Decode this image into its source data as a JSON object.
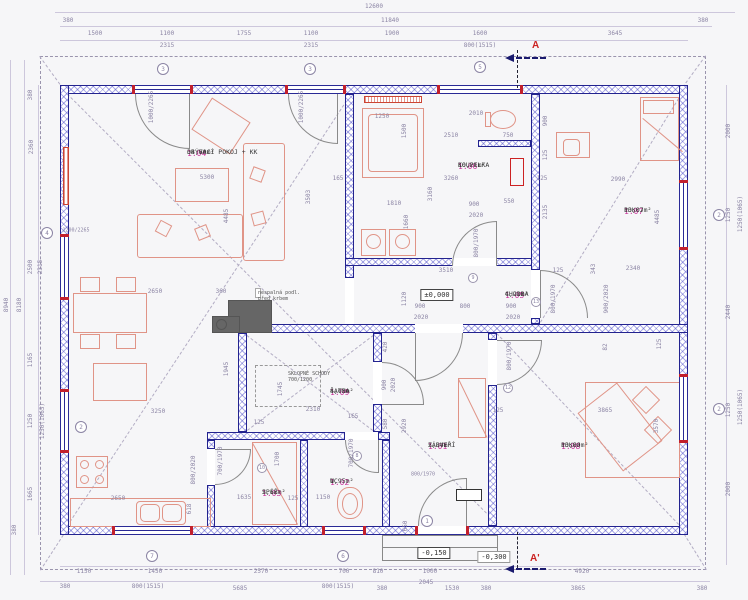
{
  "rooms": [
    {
      "id": "1.01",
      "name": "ZÁDVEŘÍ",
      "area": "5,84m²"
    },
    {
      "id": "1.02",
      "name": "WC",
      "area": "1,95m²"
    },
    {
      "id": "1.03",
      "name": "SPÍŽ",
      "area": "2,66m²"
    },
    {
      "id": "1.04",
      "name": "OBÝVACÍ POKOJ + KK",
      "area": "34,60m²"
    },
    {
      "id": "1.05",
      "name": "CHODBA",
      "area": "4,21m²"
    },
    {
      "id": "1.06",
      "name": "KOUPELKA",
      "area": "10,21m²"
    },
    {
      "id": "1.07",
      "name": "POKOJ",
      "area": "13,07m²"
    },
    {
      "id": "1.08",
      "name": "POKOJ",
      "area": "13,80m²"
    },
    {
      "id": "1.09",
      "name": "ŠATNA",
      "area": "4,03m²"
    }
  ],
  "levels": {
    "zero": "±0,000",
    "minus150": "-0,150",
    "minus300": "-0,300"
  },
  "sections": {
    "top": "A",
    "bottom": "A'"
  },
  "notes": {
    "fireplace_line1": "nespalná podl.",
    "fireplace_line2": "před krbem",
    "stairs_line1": "SKLOPNÉ SCHODY",
    "stairs_line2": "700/1200"
  },
  "bubbles": [
    "3",
    "3",
    "5",
    "4",
    "2",
    "2",
    "2",
    "7",
    "6",
    "1"
  ],
  "tags": [
    "9",
    "13",
    "12",
    "10",
    "8"
  ],
  "dims": {
    "top": [
      "12600",
      "11840",
      "380",
      "380",
      "1500",
      "1100",
      "1755",
      "1100",
      "1900",
      "1600",
      "3645",
      "2315",
      "2315",
      "800(1515)"
    ],
    "left": [
      "8940",
      "8180",
      "380",
      "2360",
      "2500",
      "2315",
      "1165",
      "1250",
      "1250(1065)",
      "1665",
      "380"
    ],
    "right": [
      "2000",
      "1250",
      "1250(1065)",
      "2440",
      "1250",
      "1250(1065)",
      "2000"
    ],
    "bottom": [
      "1150",
      "1450",
      "2570",
      "700",
      "810",
      "1000",
      "4920",
      "380",
      "800(1515)",
      "5685",
      "800(1515)",
      "380",
      "2045",
      "1530",
      "380",
      "3865",
      "380"
    ],
    "inner": [
      "1000/2265",
      "1000/2265",
      "1200/2265",
      "5300",
      "4485",
      "3503",
      "165",
      "2650",
      "360",
      "3250",
      "2650",
      "618",
      "1945",
      "1250",
      "2010",
      "750",
      "1500",
      "2510",
      "3260",
      "3160",
      "1810",
      "1660",
      "900",
      "2020",
      "550",
      "800/1970",
      "3510",
      "125",
      "343",
      "1120",
      "900",
      "2020",
      "800",
      "900",
      "2020",
      "800/1970",
      "900/2020",
      "900",
      "125",
      "2990",
      "125",
      "2135",
      "4485",
      "2340",
      "1745",
      "2310",
      "165",
      "125",
      "420",
      "900",
      "2020",
      "580",
      "2920",
      "1700",
      "700/1970",
      "1635",
      "125",
      "1150",
      "700/1970",
      "800/2020",
      "3865",
      "3570",
      "82",
      "125",
      "125",
      "800/1970",
      "800/1970",
      "650"
    ]
  }
}
